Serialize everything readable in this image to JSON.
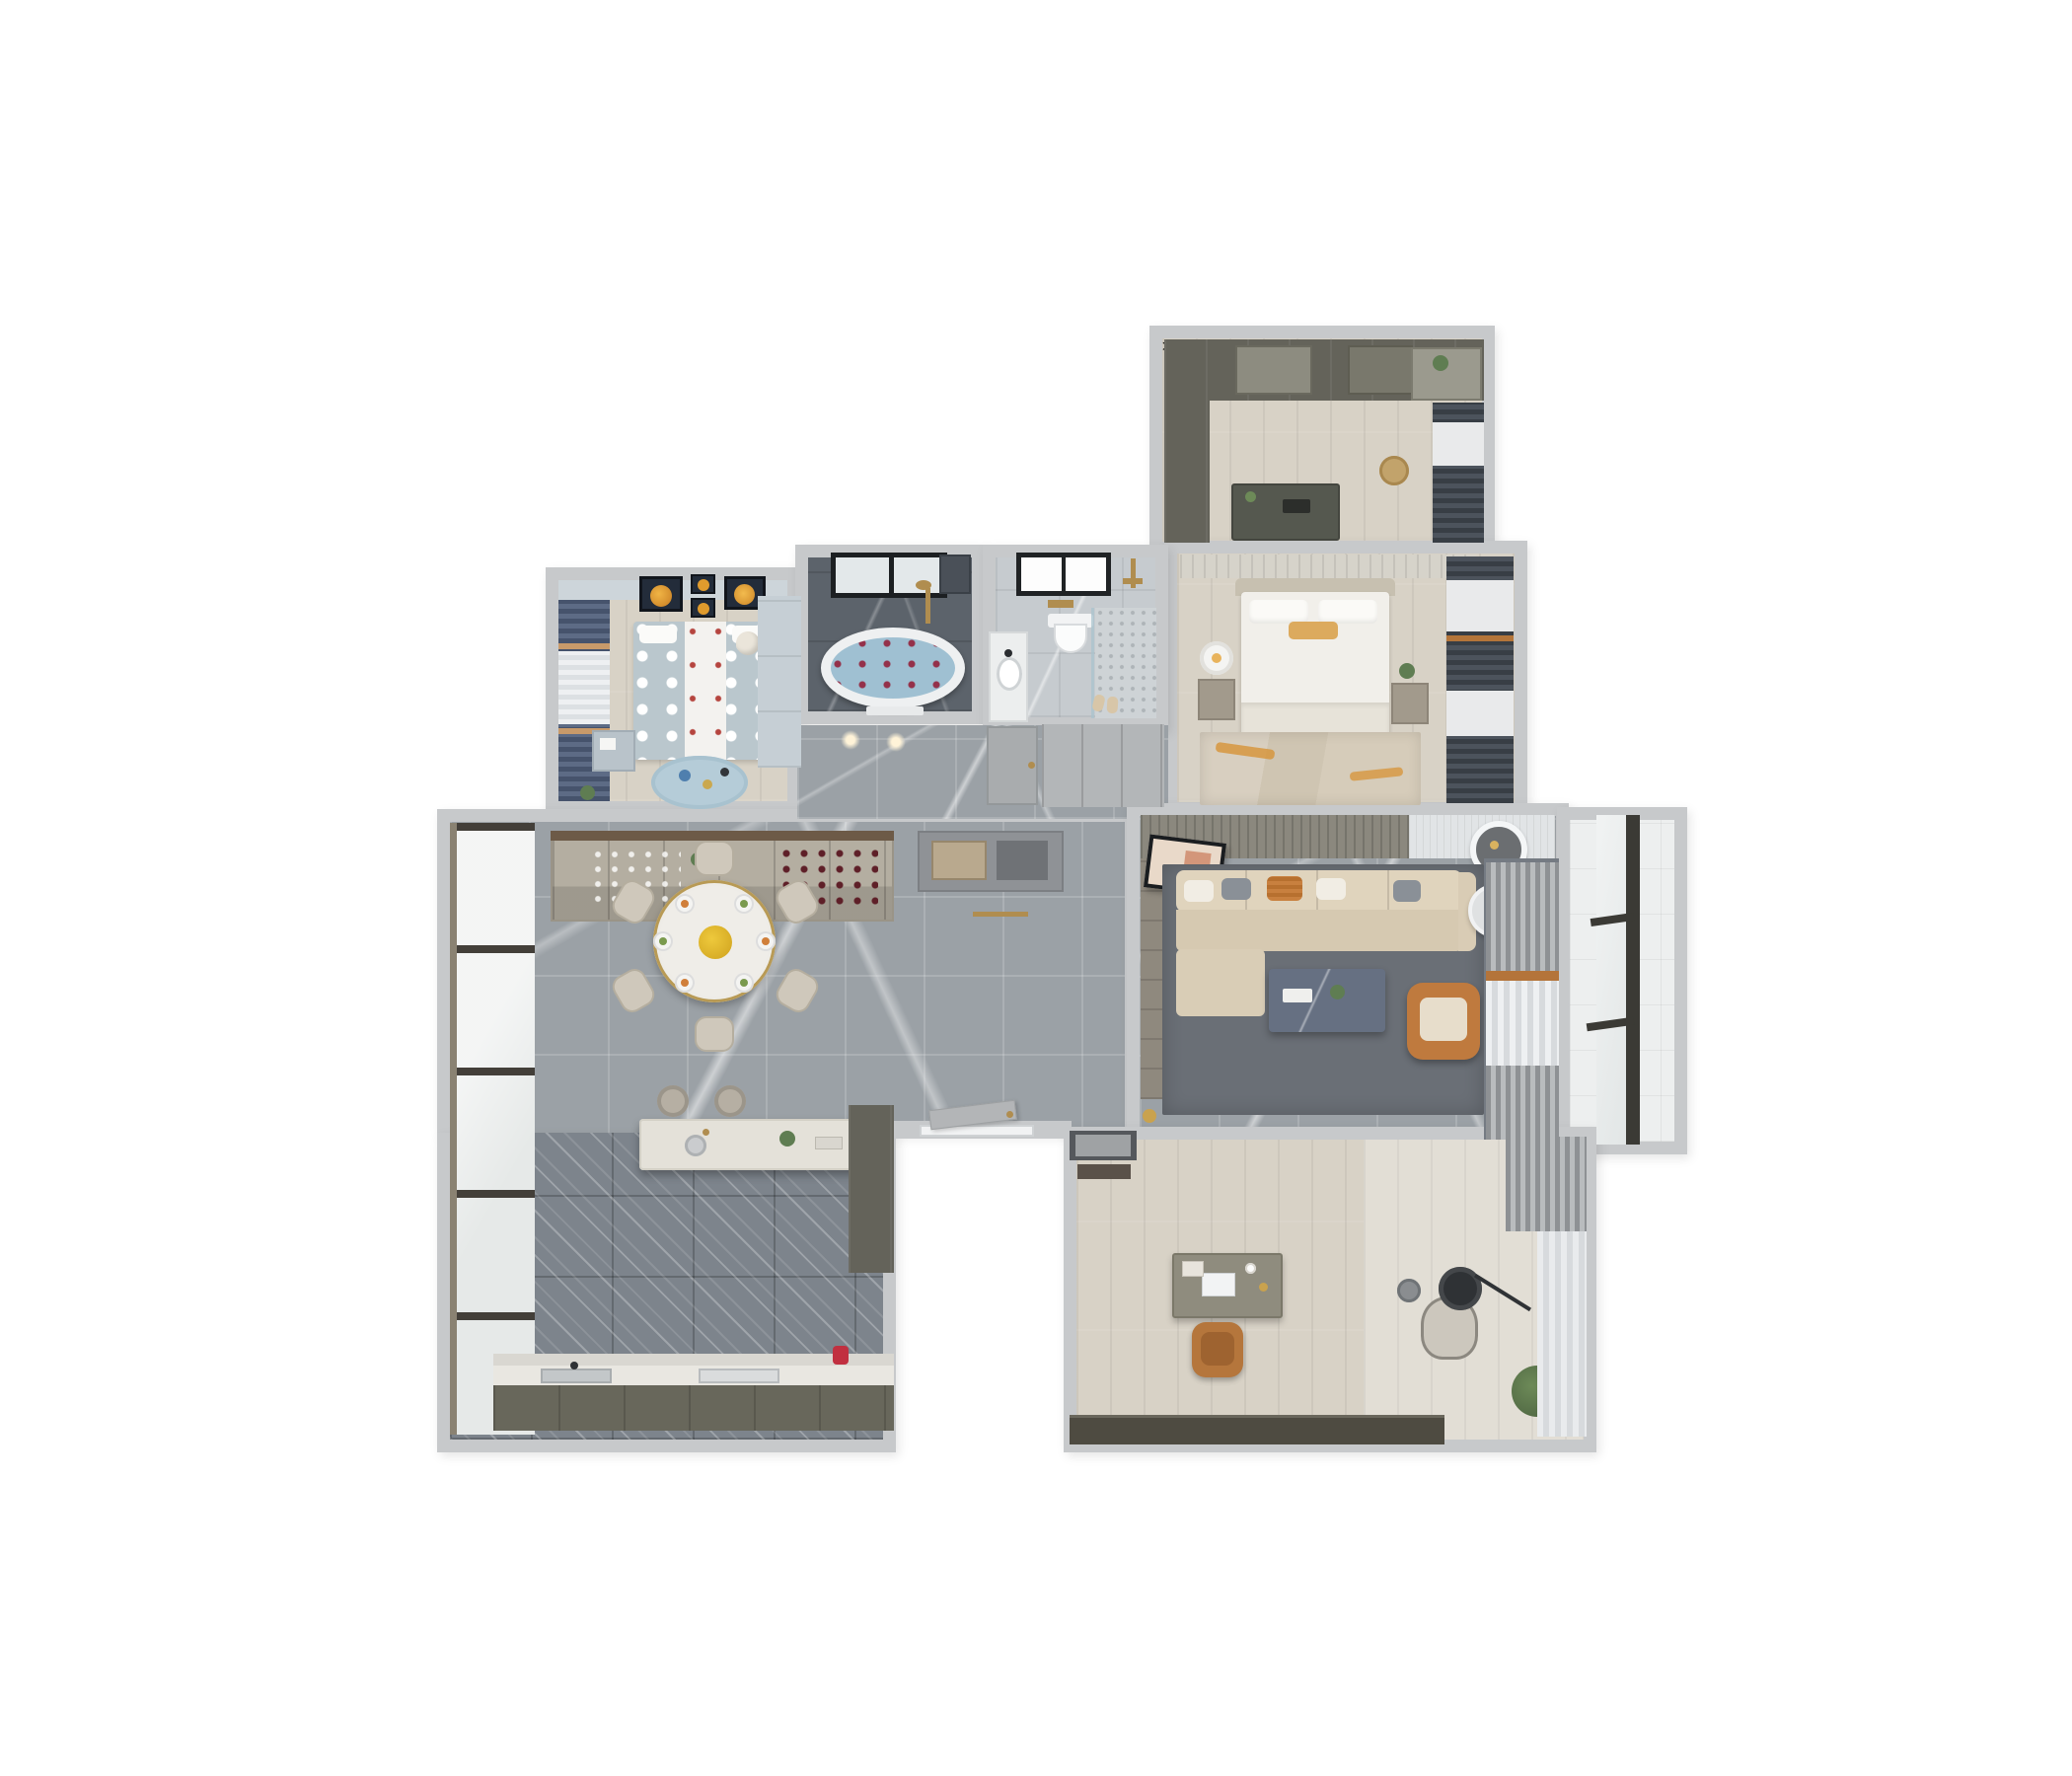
{
  "meta": {
    "description": "Photorealistic top-down 3D dollhouse floor plan render of a furnished apartment on a white background",
    "view": "top-down 3d cutaway floor plan",
    "text_visible": false,
    "background": "#ffffff"
  },
  "palette": {
    "wall": "#c7c9cb",
    "wood_floor": "#d8d2c6",
    "wood_floor_light": "#e2ded5",
    "gray_marble_floor": "#9ba1a6",
    "dark_kitchen_tile": "#7d848c",
    "dark_bath_marble": "#5c636b",
    "light_bath_floor": "#c6cbcf",
    "balcony_white_tile": "#edefef",
    "cabinet_olive": "#64635a",
    "wine_cabinet_greige": "#b4aea1",
    "sofa_beige": "#d8cbb4",
    "accent_orange": "#c07a3f",
    "accent_gold": "#b08d4f",
    "curtain_navy": "#4e5c74",
    "curtain_dark": "#3f454b",
    "kids_blue": "#c3ccd2",
    "bath_water_blue": "#a3c2d3",
    "living_rug_gray": "#6a6f76",
    "window_frame_dark": "#3b3a35"
  },
  "counts": {
    "dining_chairs": 6,
    "dining_place_settings": 6,
    "bar_stools": 2,
    "kids_art_frames": 4,
    "sofa_throw_pillows": 5
  },
  "rooms": [
    {
      "id": "walk-in-closet",
      "name": "Walk-in closet",
      "furniture": [
        "wardrobe wall",
        "tall side cabinet",
        "island dresser",
        "rattan laundry basket",
        "dresser with mirror and plants",
        "window curtains"
      ]
    },
    {
      "id": "master-bedroom",
      "name": "Master bedroom",
      "furniture": [
        "upholstered headboard wall",
        "double bed with white duvet",
        "gold accent pillow",
        "nightstand with table lamp",
        "nightstand with plant",
        "distressed rug with orange accents",
        "dark window curtains"
      ]
    },
    {
      "id": "kids-bedroom",
      "name": "Kids bedroom",
      "furniture": [
        "orange planet wall art frames",
        "navy curtains",
        "polka-dot bed",
        "light blue wardrobe",
        "desk",
        "round play rug with toys",
        "teddy bear",
        "potted plant"
      ]
    },
    {
      "id": "bathroom-tub",
      "name": "Bathroom with tub",
      "furniture": [
        "black framed window",
        "freestanding oval bathtub with rose petals",
        "gold shower fixture",
        "towel rail",
        "dark marble walls"
      ]
    },
    {
      "id": "bathroom-shower",
      "name": "Bathroom with shower",
      "furniture": [
        "black framed window",
        "wall-hung toilet",
        "gold flush plate",
        "vanity with round sink",
        "walk-in shower with gold fixtures",
        "glass partition",
        "slippers"
      ]
    },
    {
      "id": "hallway",
      "name": "Hallway",
      "furniture": [
        "entry console cabinet with niche",
        "paneled interior doors",
        "ceiling spotlights",
        "gold floor threshold strip"
      ]
    },
    {
      "id": "dining-room",
      "name": "Dining room",
      "furniture": [
        "wine display sideboard",
        "round dining table with gold rim",
        "six dining chairs",
        "plated food settings",
        "yellow flower centerpiece",
        "floor-to-ceiling windows"
      ]
    },
    {
      "id": "kitchen",
      "name": "Open kitchen",
      "furniture": [
        "terrazzo island counter with prep sink",
        "two bar stools",
        "tall olive cabinet",
        "base cabinets",
        "main sink",
        "cooktop",
        "red kettle"
      ]
    },
    {
      "id": "living-room",
      "name": "Living room",
      "furniture": [
        "slatted wood ceiling panel",
        "round ceiling light",
        "leaning artwork",
        "wood tv wall",
        "beige sectional sofa",
        "throw pillows",
        "round white side table",
        "dark marble coffee table",
        "orange leather armchair",
        "gray area rug",
        "layered curtains",
        "gold floor lamp"
      ]
    },
    {
      "id": "study",
      "name": "Study",
      "furniture": [
        "entry door with mat",
        "desk with laptop and books",
        "brown leather desk chair",
        "lounge chair",
        "black floor lamp",
        "potted plant",
        "low dark cabinet",
        "sheer window curtains"
      ]
    },
    {
      "id": "balcony",
      "name": "Balcony",
      "furniture": [
        "white tile floor",
        "full-height dark framed window"
      ]
    },
    {
      "id": "entry",
      "name": "Entry recess",
      "furniture": [
        "front door ajar",
        "white door frame"
      ]
    }
  ]
}
